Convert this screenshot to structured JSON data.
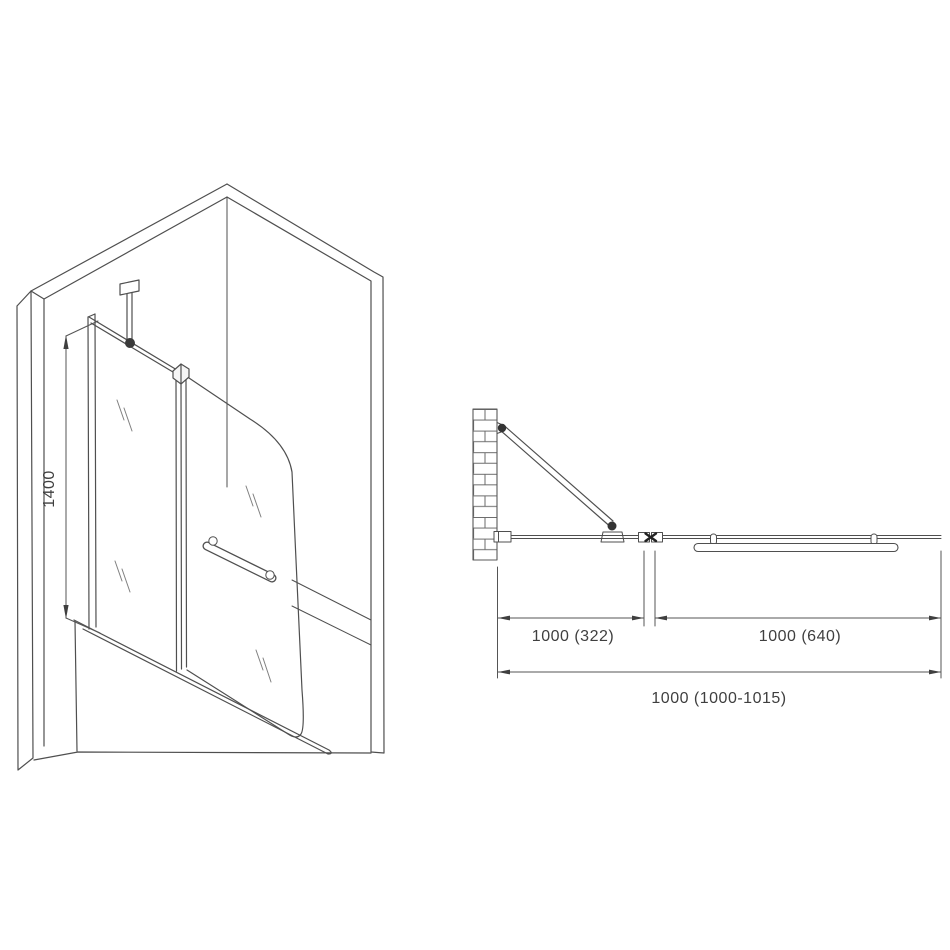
{
  "page": {
    "background_color": "#ffffff"
  },
  "drawing": {
    "colors": {
      "line": "#4f4f4f",
      "thin_line": "#6b6b6b",
      "hinge_dark": "#333333",
      "dimension_text": "#3f3f3f"
    },
    "isometric_view": {
      "height_dimension_label": "1400"
    },
    "plan_view": {
      "fixed_panel_dimension_label": "1000 (322)",
      "door_panel_dimension_label": "1000 (640)",
      "overall_dimension_label": "1000 (1000-1015)"
    }
  }
}
